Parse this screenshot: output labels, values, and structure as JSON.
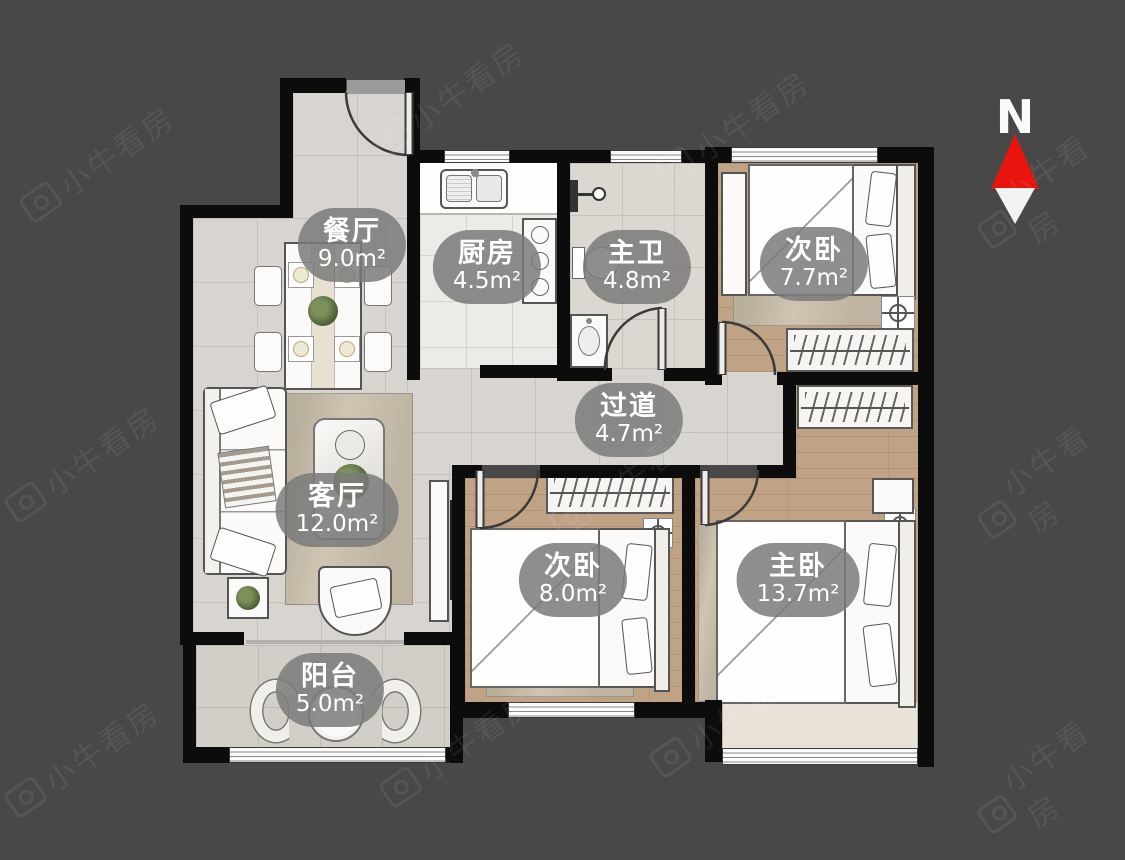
{
  "page": {
    "type": "apartment-floor-plan",
    "background": "#484848"
  },
  "watermark": {
    "text": "小牛看房"
  },
  "compass": {
    "label": "N"
  },
  "rooms": [
    {
      "key": "dining",
      "name": "餐厅",
      "area": "9.0m²"
    },
    {
      "key": "kitchen",
      "name": "厨房",
      "area": "4.5m²"
    },
    {
      "key": "master-bath",
      "name": "主卫",
      "area": "4.8m²"
    },
    {
      "key": "bedroom-north",
      "name": "次卧",
      "area": "7.7m²"
    },
    {
      "key": "hallway",
      "name": "过道",
      "area": "4.7m²"
    },
    {
      "key": "living",
      "name": "客厅",
      "area": "12.0m²"
    },
    {
      "key": "bedroom-south",
      "name": "次卧",
      "area": "8.0m²"
    },
    {
      "key": "master-bedroom",
      "name": "主卧",
      "area": "13.7m²"
    },
    {
      "key": "balcony",
      "name": "阳台",
      "area": "5.0m²"
    }
  ],
  "colors": {
    "wall": "#0c0c0c",
    "tile_floor": "#d8d5d0",
    "wood_floor": "#c0a284",
    "label_bubble": "#7a7a7a",
    "north_red": "#ea140e",
    "background": "#484848"
  }
}
